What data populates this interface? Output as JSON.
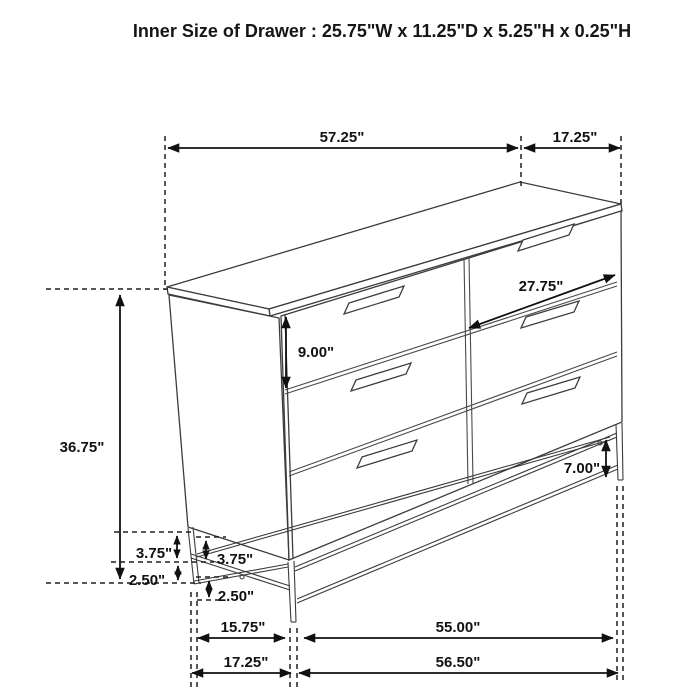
{
  "title": "Inner Size of Drawer : 25.75\"W x 11.25\"D x 5.25\"H x 0.25\"H",
  "dims": {
    "width_top": "57.25\"",
    "depth_top": "17.25\"",
    "total_height": "36.75\"",
    "drawer_height": "9.00\"",
    "drawer_width": "27.75\"",
    "base_clearance": "7.00\"",
    "base_frame_height_side": "3.75\"",
    "base_frame_height_front": "3.75\"",
    "leg_height_side": "2.50\"",
    "leg_height_front": "2.50\"",
    "base_depth_inner": "15.75\"",
    "base_width_inner": "55.00\"",
    "base_depth_outer": "17.25\"",
    "base_width_outer": "56.50\""
  },
  "colors": {
    "background": "#ffffff",
    "drawing_line": "#3c3c3c",
    "dimension_line": "#111111"
  }
}
